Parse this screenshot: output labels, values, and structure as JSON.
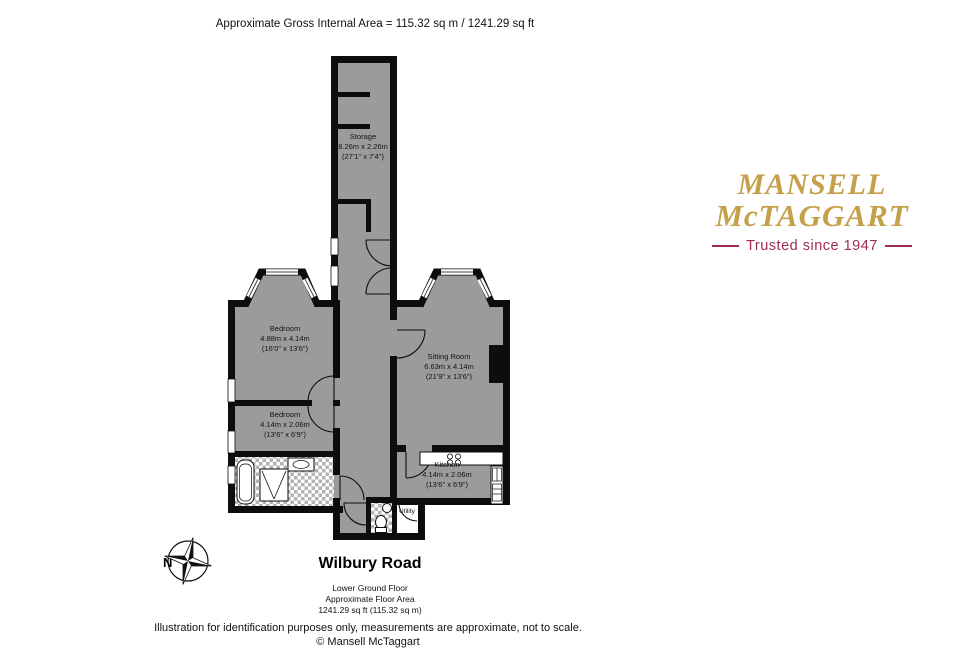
{
  "header": {
    "gross_area": "Approximate Gross Internal Area = 115.32 sq m / 1241.29 sq ft"
  },
  "logo": {
    "line1": "MANSELL",
    "line2": "McTAGGART",
    "tagline": "Trusted since 1947"
  },
  "compass": {
    "north_label": "N"
  },
  "rooms": {
    "storage": {
      "name": "Storage",
      "dims_metric": "8.26m x 2.26m",
      "dims_imperial": "(27'1\" x 7'4\")"
    },
    "bedroom_1": {
      "name": "Bedroom",
      "dims_metric": "4.88m x 4.14m",
      "dims_imperial": "(16'0\" x 13'6\")"
    },
    "sitting_room": {
      "name": "Sitting Room",
      "dims_metric": "6.63m x 4.14m",
      "dims_imperial": "(21'9\" x 13'6\")"
    },
    "bedroom_2": {
      "name": "Bedroom",
      "dims_metric": "4.14m x 2.06m",
      "dims_imperial": "(13'6\" x 6'9\")"
    },
    "kitchen": {
      "name": "Kitchen",
      "dims_metric": "4.14m x 2.06m",
      "dims_imperial": "(13'6\" x 6'9\")"
    },
    "utility": {
      "name": "Utility"
    }
  },
  "footer": {
    "street": "Wilbury Road",
    "floor": "Lower Ground Floor",
    "area_label": "Approximate Floor Area",
    "area_value": "1241.29 sq ft (115.32 sq m)",
    "disclaimer": "Illustration for identification purposes only, measurements are approximate, not to scale.",
    "copyright": "© Mansell McTaggart"
  },
  "colors": {
    "floor_gray": "#9b9b9b",
    "wall_black": "#0d0d0d",
    "logo_gold": "#c5a04a",
    "logo_maroon": "#9e2d4d"
  }
}
